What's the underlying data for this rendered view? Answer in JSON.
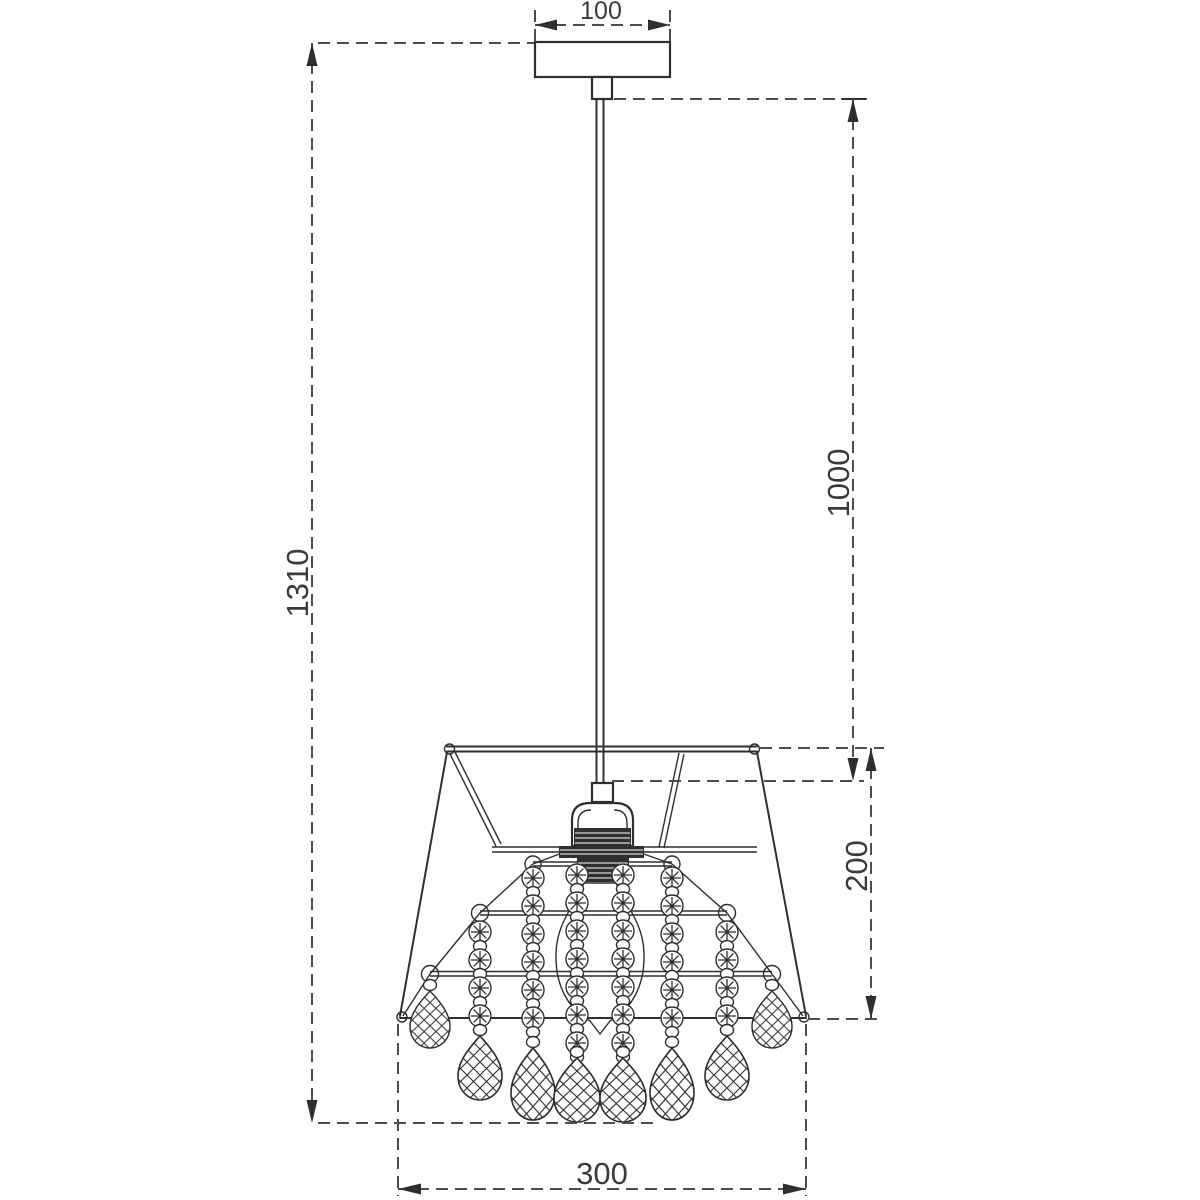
{
  "drawing": {
    "type": "pendant-lamp-dimension-drawing",
    "labels": {
      "canopy_width": "100",
      "cord_length": "1000",
      "overall_height": "1310",
      "shade_height": "200",
      "shade_width": "300"
    },
    "colors": {
      "line": "#2f2f2f",
      "dimension_line": "#4d4d4d",
      "text": "#3a3a3a",
      "background": "#ffffff"
    }
  }
}
